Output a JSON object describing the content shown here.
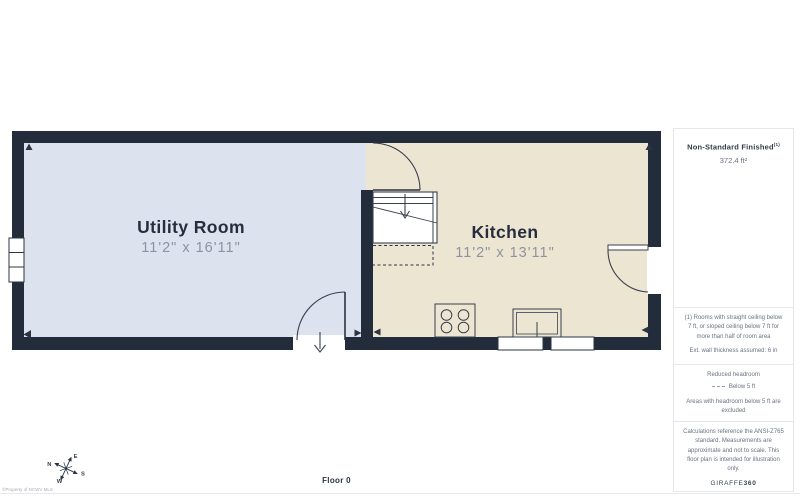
{
  "plan": {
    "floor_label": "Floor 0",
    "copyright": "©Property of NCWV MLS",
    "rooms": [
      {
        "name": "Utility Room",
        "dimensions": "11'2\" x 16'11\""
      },
      {
        "name": "Kitchen",
        "dimensions": "11'2\" x 13'11\""
      }
    ],
    "compass": {
      "n": "N",
      "e": "E",
      "s": "S",
      "w": "W"
    }
  },
  "sidebar": {
    "area_title": "Non-Standard Finished",
    "area_footnote_marker": "(1)",
    "area_value": "372.4 ft²",
    "footnote": "(1) Rooms with straight ceiling below 7 ft, or sloped ceiling below 7 ft for more than half of room area",
    "wall_note": "Ext. wall thickness assumed: 6 in",
    "headroom_title": "Reduced headroom",
    "headroom_key_label": "Below 5 ft",
    "headroom_note": "Areas with headroom below 5 ft are excluded",
    "disclaimer": "Calculations reference the ANSI-Z765 standard. Measurements are approximate and not to scale. This floor plan is intended for illustration only.",
    "brand": "GIRAFFE",
    "brand_suffix": "360"
  },
  "colors": {
    "wall": "#232c3a",
    "utility_floor": "#dce2ee",
    "kitchen_floor": "#ece5d2",
    "label_dark": "#262e3d",
    "label_gray": "#8d93a1",
    "line": "#39404f",
    "border": "#e6e7ea"
  }
}
